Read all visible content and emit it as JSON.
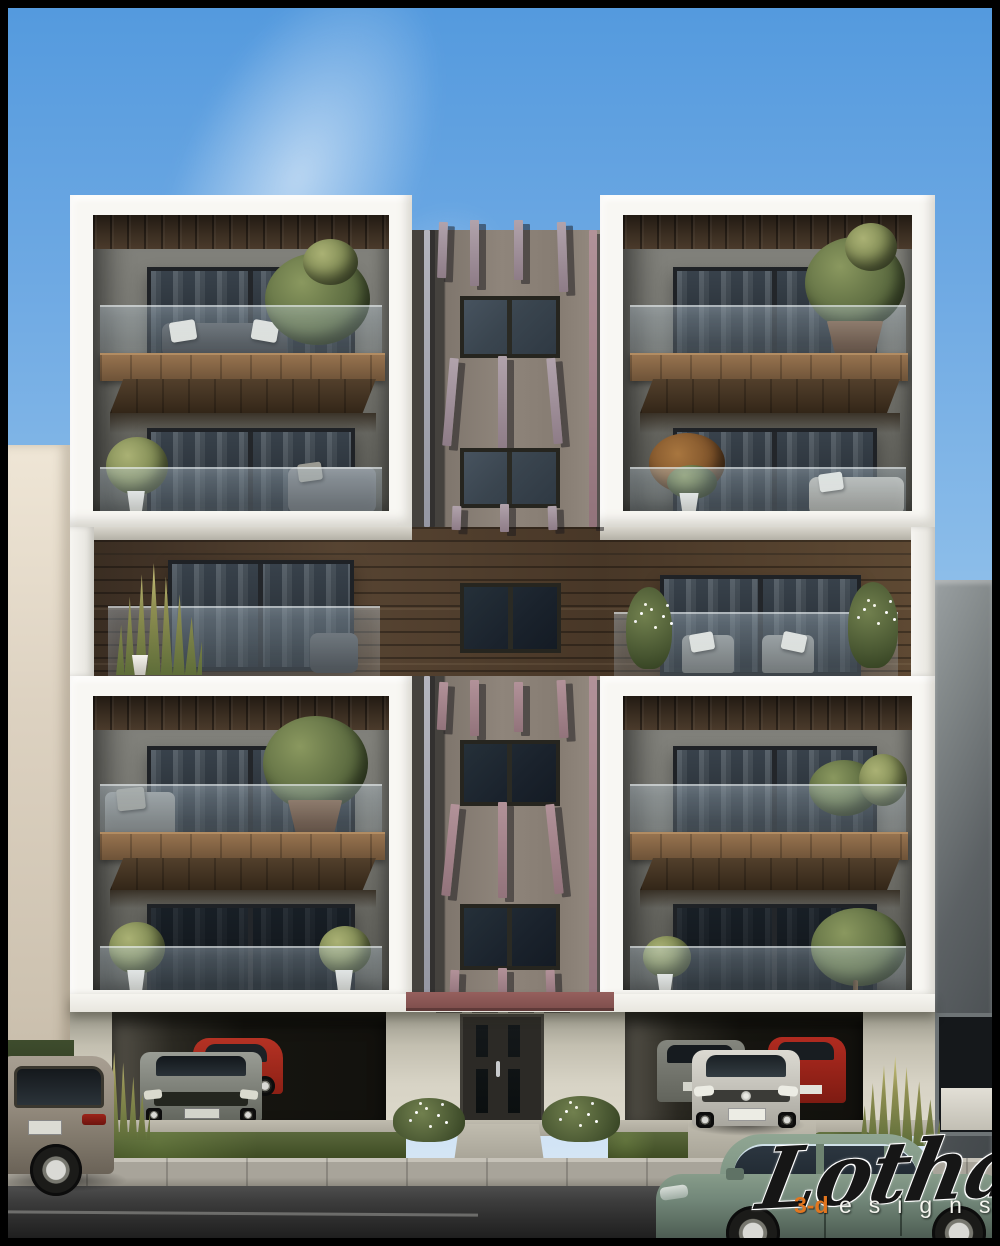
{
  "meta": {
    "type": "architectural-3d-render",
    "description": "Street-facing elevation of a modern five-storey apartment building with four white-framed balcony volumes, a central concrete strip with mauve fins, wood-clad middle floor, twin ground-floor garages with parked cars, and a green sedan in the foreground"
  },
  "watermark": {
    "brand": "Lothal",
    "sub_prefix": "3-d",
    "sub_rest": "esigns"
  },
  "palette": {
    "border": "#000000",
    "sky_top": "#549ade",
    "sky_bottom": "#dcebf7",
    "frame_white": "#f8f7f3",
    "interior_wall": "#787872",
    "ceiling_wood": "#3c2f22",
    "balcony_slab_wood": "#97734f",
    "mid_band_wood": "#574432",
    "concrete_strip": "#8f857b",
    "fin_mauve": "#9d8a94",
    "fin_pink": "#a2838b",
    "red_band": "#8a5756",
    "window_glass": "#3b454f",
    "balustrade_glass": "rgba(185,205,220,0.34)",
    "ground_wall": "#d7d3c5",
    "garage_dark": "#161510",
    "grass": "#44522f",
    "sidewalk": "#a8a49a",
    "street": "#3c3c3c",
    "neighbor_left": "#ddd2c1",
    "neighbor_right": "#5c6164",
    "car_green": "#7e9180",
    "car_silver": "#d3d1c9",
    "car_red": "#a8291e",
    "car_grey": "#8e9189",
    "watermark_orange": "#e2761f"
  },
  "scene": {
    "objects": [
      "sky with wispy cloud",
      "beige neighbor building left",
      "grey neighbor building right",
      "four white balcony box units with trees, sofas and glass balustrades",
      "central fin strip with stacked small windows",
      "wood-clad middle floor with three windows and lounge chairs",
      "entrance door with glass slits",
      "left garage: grey sedan and red hatchback",
      "right garage: silver car, grey car, red car",
      "grey SUV parked at left curb",
      "green sedan driving in foreground",
      "grass beds, white-flower bushes, ornamental grasses",
      "sidewalk and asphalt street"
    ]
  }
}
